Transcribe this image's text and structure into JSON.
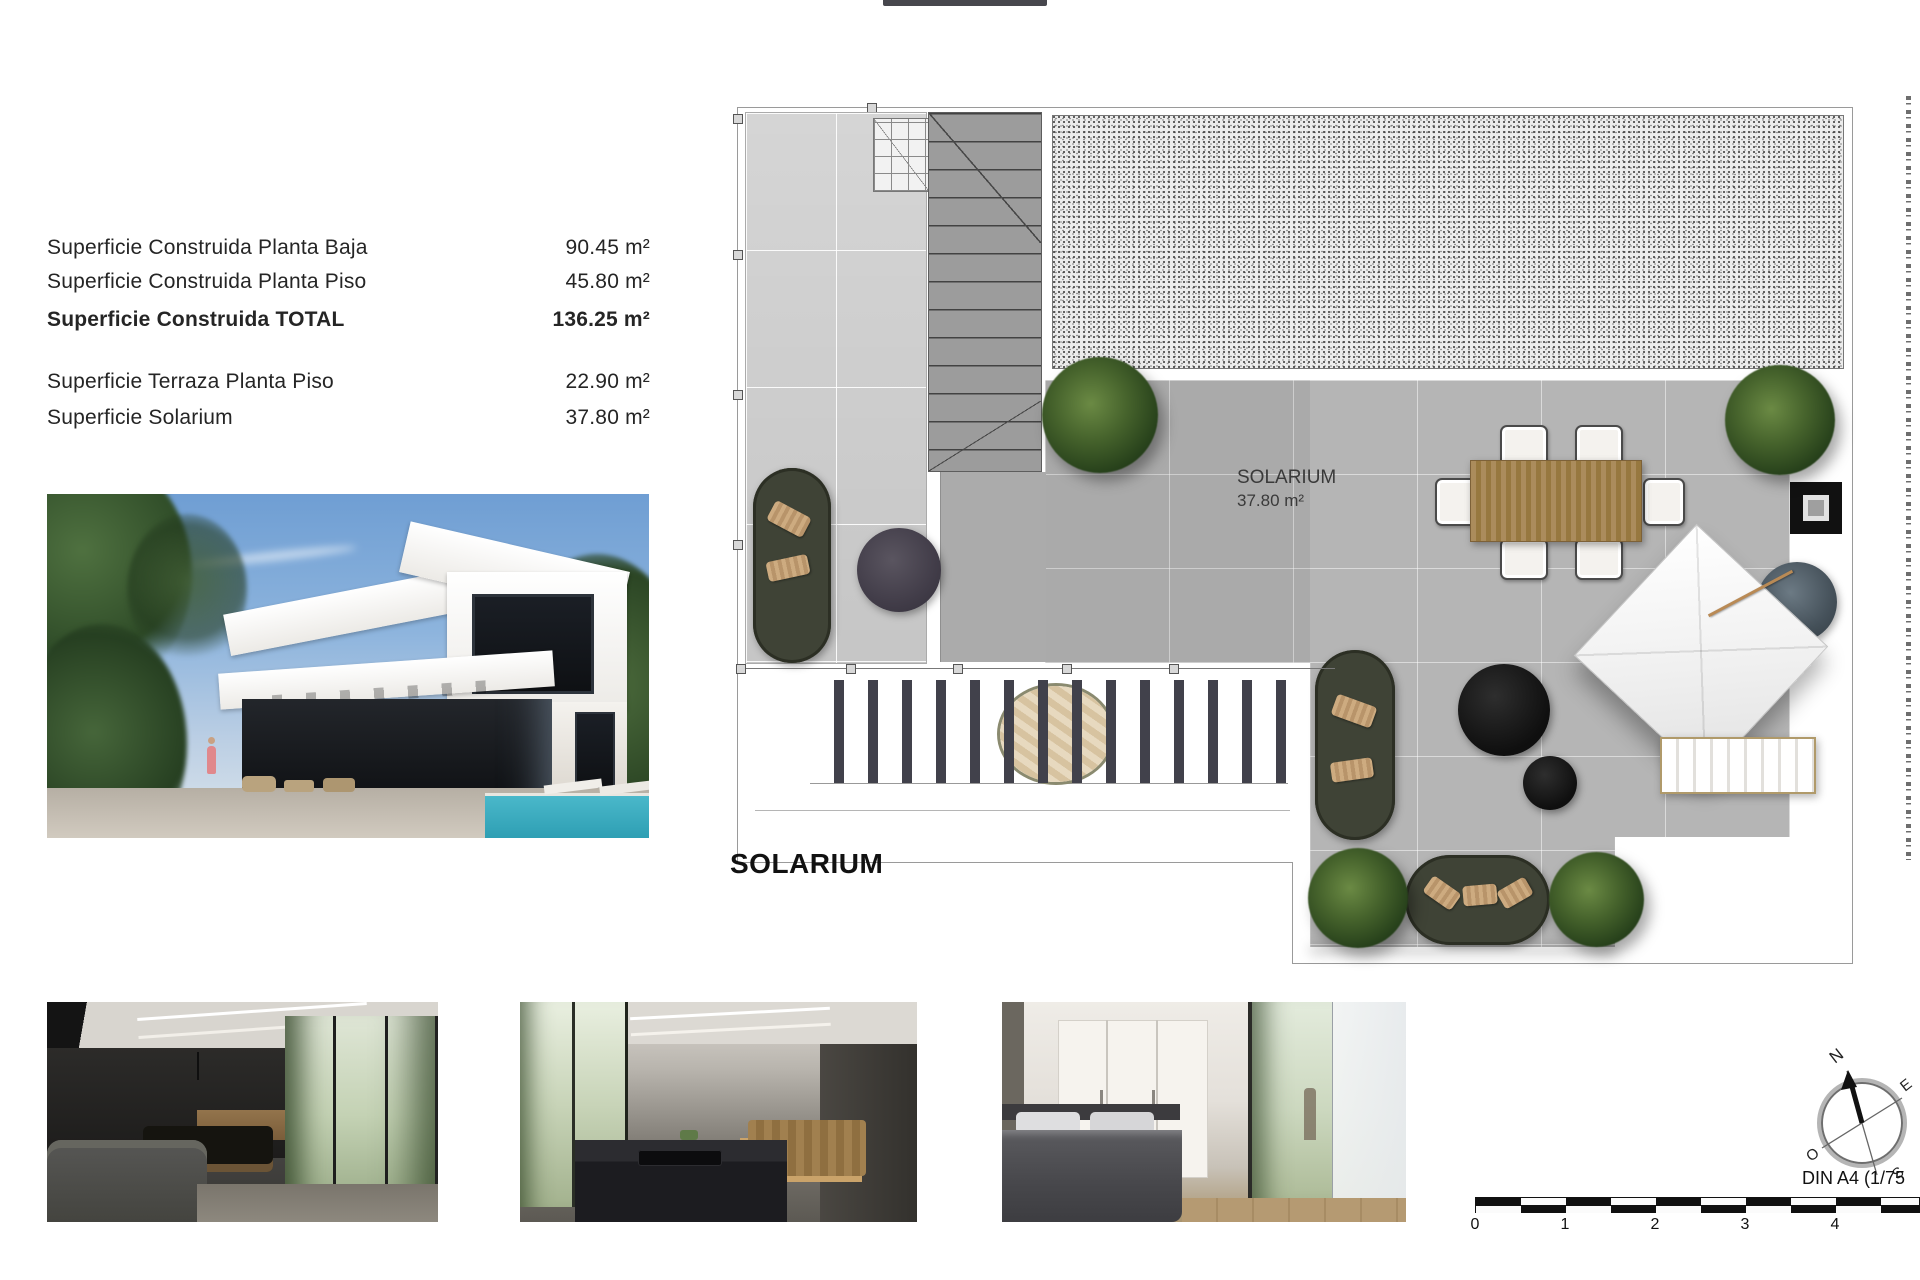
{
  "surfaces": {
    "rows": [
      {
        "label": "Superficie Construida Planta Baja",
        "value": "90.45 m²"
      },
      {
        "label": "Superficie Construida Planta Piso",
        "value": "45.80 m²"
      },
      {
        "label": "Superficie Construida TOTAL",
        "value": "136.25 m²"
      },
      {
        "label": "Superficie Terraza Planta Piso",
        "value": "22.90 m²"
      },
      {
        "label": "Superficie Solarium",
        "value": "37.80 m²"
      }
    ]
  },
  "plan": {
    "title": "SOLARIUM",
    "room_label": "SOLARIUM",
    "room_area": "37.80 m²"
  },
  "compass": {
    "n": "N",
    "e": "E",
    "s": "S",
    "o": "O"
  },
  "scale_bar": {
    "ticks": [
      "0",
      "1",
      "2",
      "3",
      "4"
    ],
    "format_label": "DIN A4 (1/75"
  },
  "colors": {
    "deck_gray": "#b5b5b5",
    "terrace_gray": "#dcdcdc",
    "plant_green": "#46632c",
    "sofa_olive": "#3f4336",
    "wood_tan": "#ab8c5c",
    "pool_blue": "#49b7c9"
  }
}
